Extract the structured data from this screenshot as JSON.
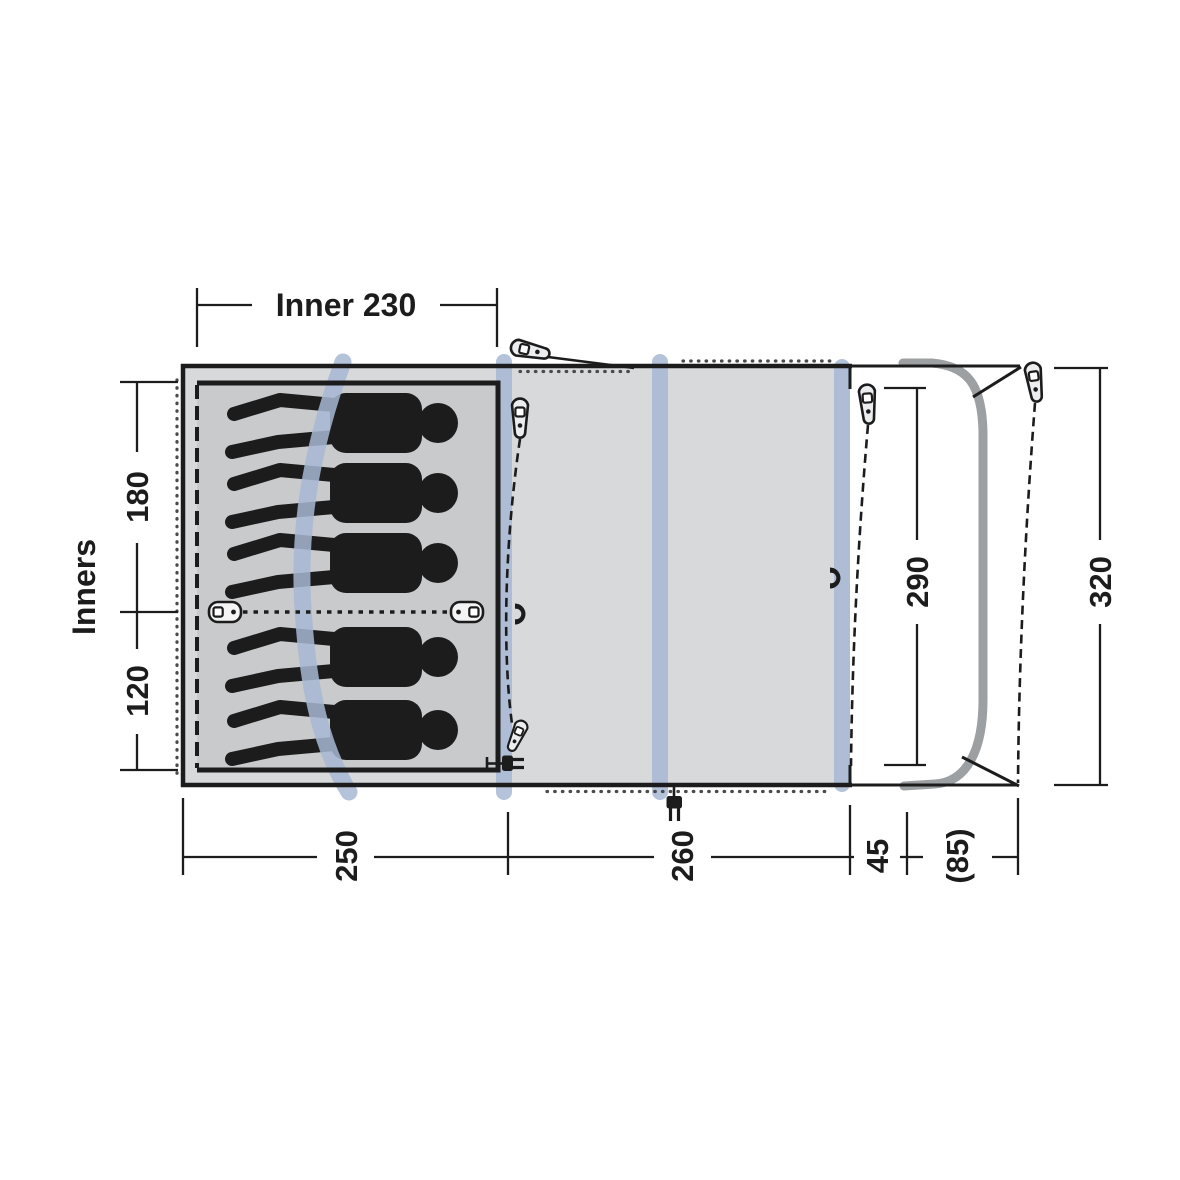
{
  "diagram": {
    "kind": "tent-floorplan-top-view",
    "sleeping_capacity": 5,
    "colors": {
      "outline": "#1c1c1c",
      "body_fill": "#d8d9db",
      "inner_cabin_fill": "#c8cacc",
      "air_tube_band": "#a7b7d4",
      "awning_pole": "#9da0a2",
      "peg_fill": "#ecedee"
    },
    "icons": [
      "peg-icon",
      "zipper-pull-icon",
      "toggle-icon",
      "magnet-icon",
      "power-plug-icon",
      "person-silhouette",
      "air-tube-band",
      "awning-pole",
      "guy-line"
    ]
  },
  "labels": {
    "inner_width": "Inner 230",
    "inners": "Inners",
    "inner_depth_back": "180",
    "inner_depth_front": "120",
    "length_bedroom": "250",
    "length_living": "260",
    "length_canopy_offset": "45",
    "length_canopy_extension": "(85)",
    "canopy_depth": "290",
    "total_depth": "320"
  }
}
